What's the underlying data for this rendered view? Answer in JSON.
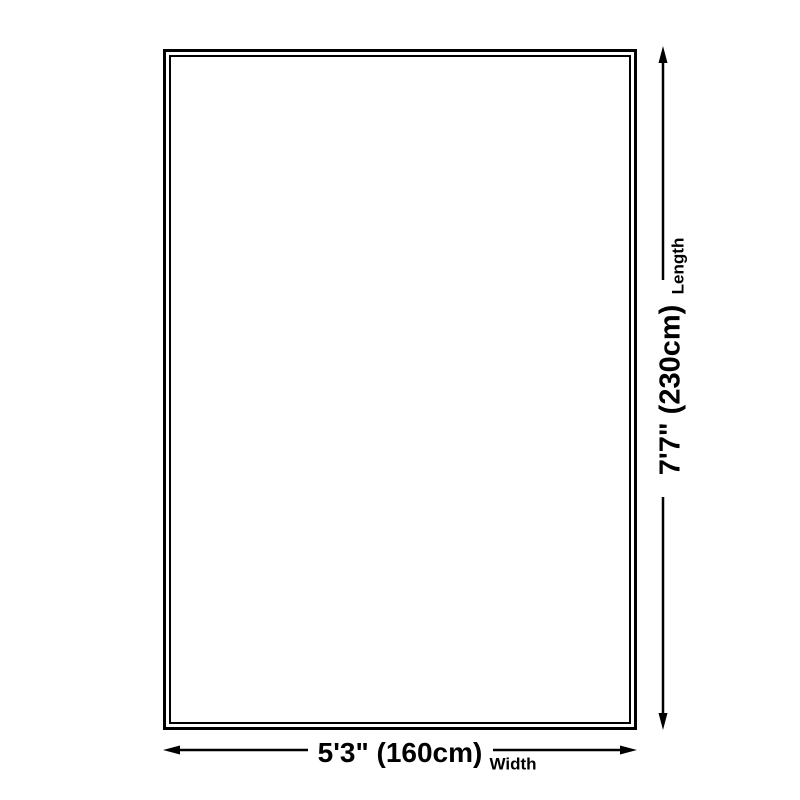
{
  "diagram": {
    "type": "product-dimensions",
    "dimensions": {
      "length": {
        "label": "Length",
        "value": "7'7\" (230cm)"
      },
      "width": {
        "label": "Width",
        "value": "5'3\" (160cm)"
      }
    },
    "colors": {
      "line": "#000000",
      "background": "#ffffff"
    }
  }
}
